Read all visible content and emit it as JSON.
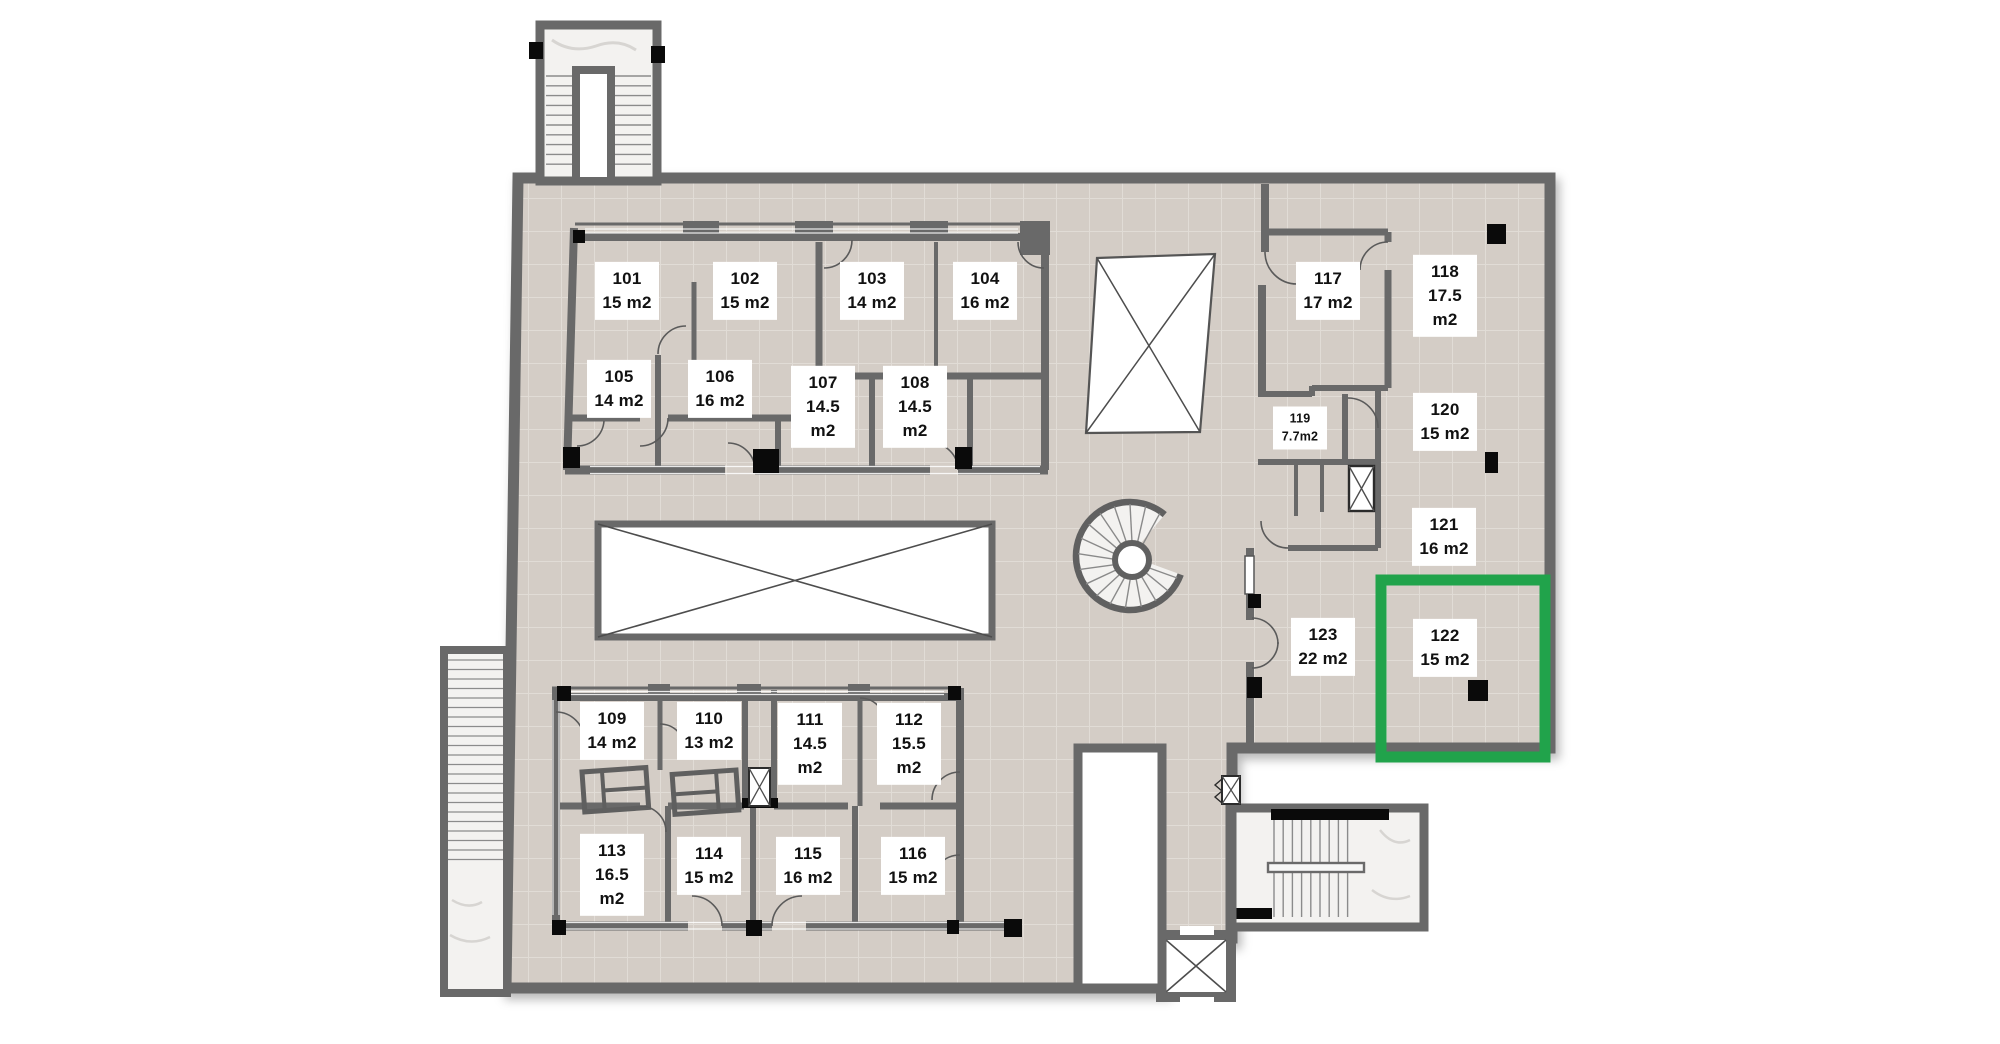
{
  "plan": {
    "name": "Apartment floor plan – first floor units 101–123",
    "floor": {
      "tile": "#d4cdc6",
      "tile_line": "#e1dcd6",
      "wall": "#696969",
      "stair_fill": "#f3f2f0",
      "void_fill": "#ffffff",
      "column": "#0a0a0a"
    },
    "highlight": {
      "room_id": "122",
      "color": "#21a34b"
    },
    "unit_suffix": "m2"
  },
  "rooms": [
    {
      "id": "101",
      "area": "15 m2",
      "x": 627,
      "y": 291
    },
    {
      "id": "102",
      "area": "15 m2",
      "x": 745,
      "y": 291
    },
    {
      "id": "103",
      "area": "14 m2",
      "x": 872,
      "y": 291
    },
    {
      "id": "104",
      "area": "16 m2",
      "x": 985,
      "y": 291
    },
    {
      "id": "105",
      "area": "14 m2",
      "x": 619,
      "y": 389
    },
    {
      "id": "106",
      "area": "16 m2",
      "x": 720,
      "y": 389
    },
    {
      "id": "107",
      "area": "14.5 m2",
      "x": 823,
      "y": 407
    },
    {
      "id": "108",
      "area": "14.5 m2",
      "x": 915,
      "y": 407
    },
    {
      "id": "109",
      "area": "14 m2",
      "x": 612,
      "y": 731
    },
    {
      "id": "110",
      "area": "13 m2",
      "x": 709,
      "y": 731
    },
    {
      "id": "111",
      "area": "14.5 m2",
      "x": 810,
      "y": 744
    },
    {
      "id": "112",
      "area": "15.5 m2",
      "x": 909,
      "y": 744
    },
    {
      "id": "113",
      "area": "16.5 m2",
      "x": 612,
      "y": 875
    },
    {
      "id": "114",
      "area": "15 m2",
      "x": 709,
      "y": 866
    },
    {
      "id": "115",
      "area": "16 m2",
      "x": 808,
      "y": 866
    },
    {
      "id": "116",
      "area": "15 m2",
      "x": 913,
      "y": 866
    },
    {
      "id": "117",
      "area": "17 m2",
      "x": 1328,
      "y": 291
    },
    {
      "id": "118",
      "area": "17.5 m2",
      "x": 1445,
      "y": 296
    },
    {
      "id": "119",
      "area": "7.7m2",
      "x": 1300,
      "y": 428,
      "small": true
    },
    {
      "id": "120",
      "area": "15 m2",
      "x": 1445,
      "y": 422
    },
    {
      "id": "121",
      "area": "16 m2",
      "x": 1444,
      "y": 537
    },
    {
      "id": "122",
      "area": "15 m2",
      "x": 1445,
      "y": 648,
      "highlighted": true
    },
    {
      "id": "123",
      "area": "22 m2",
      "x": 1323,
      "y": 647
    }
  ]
}
